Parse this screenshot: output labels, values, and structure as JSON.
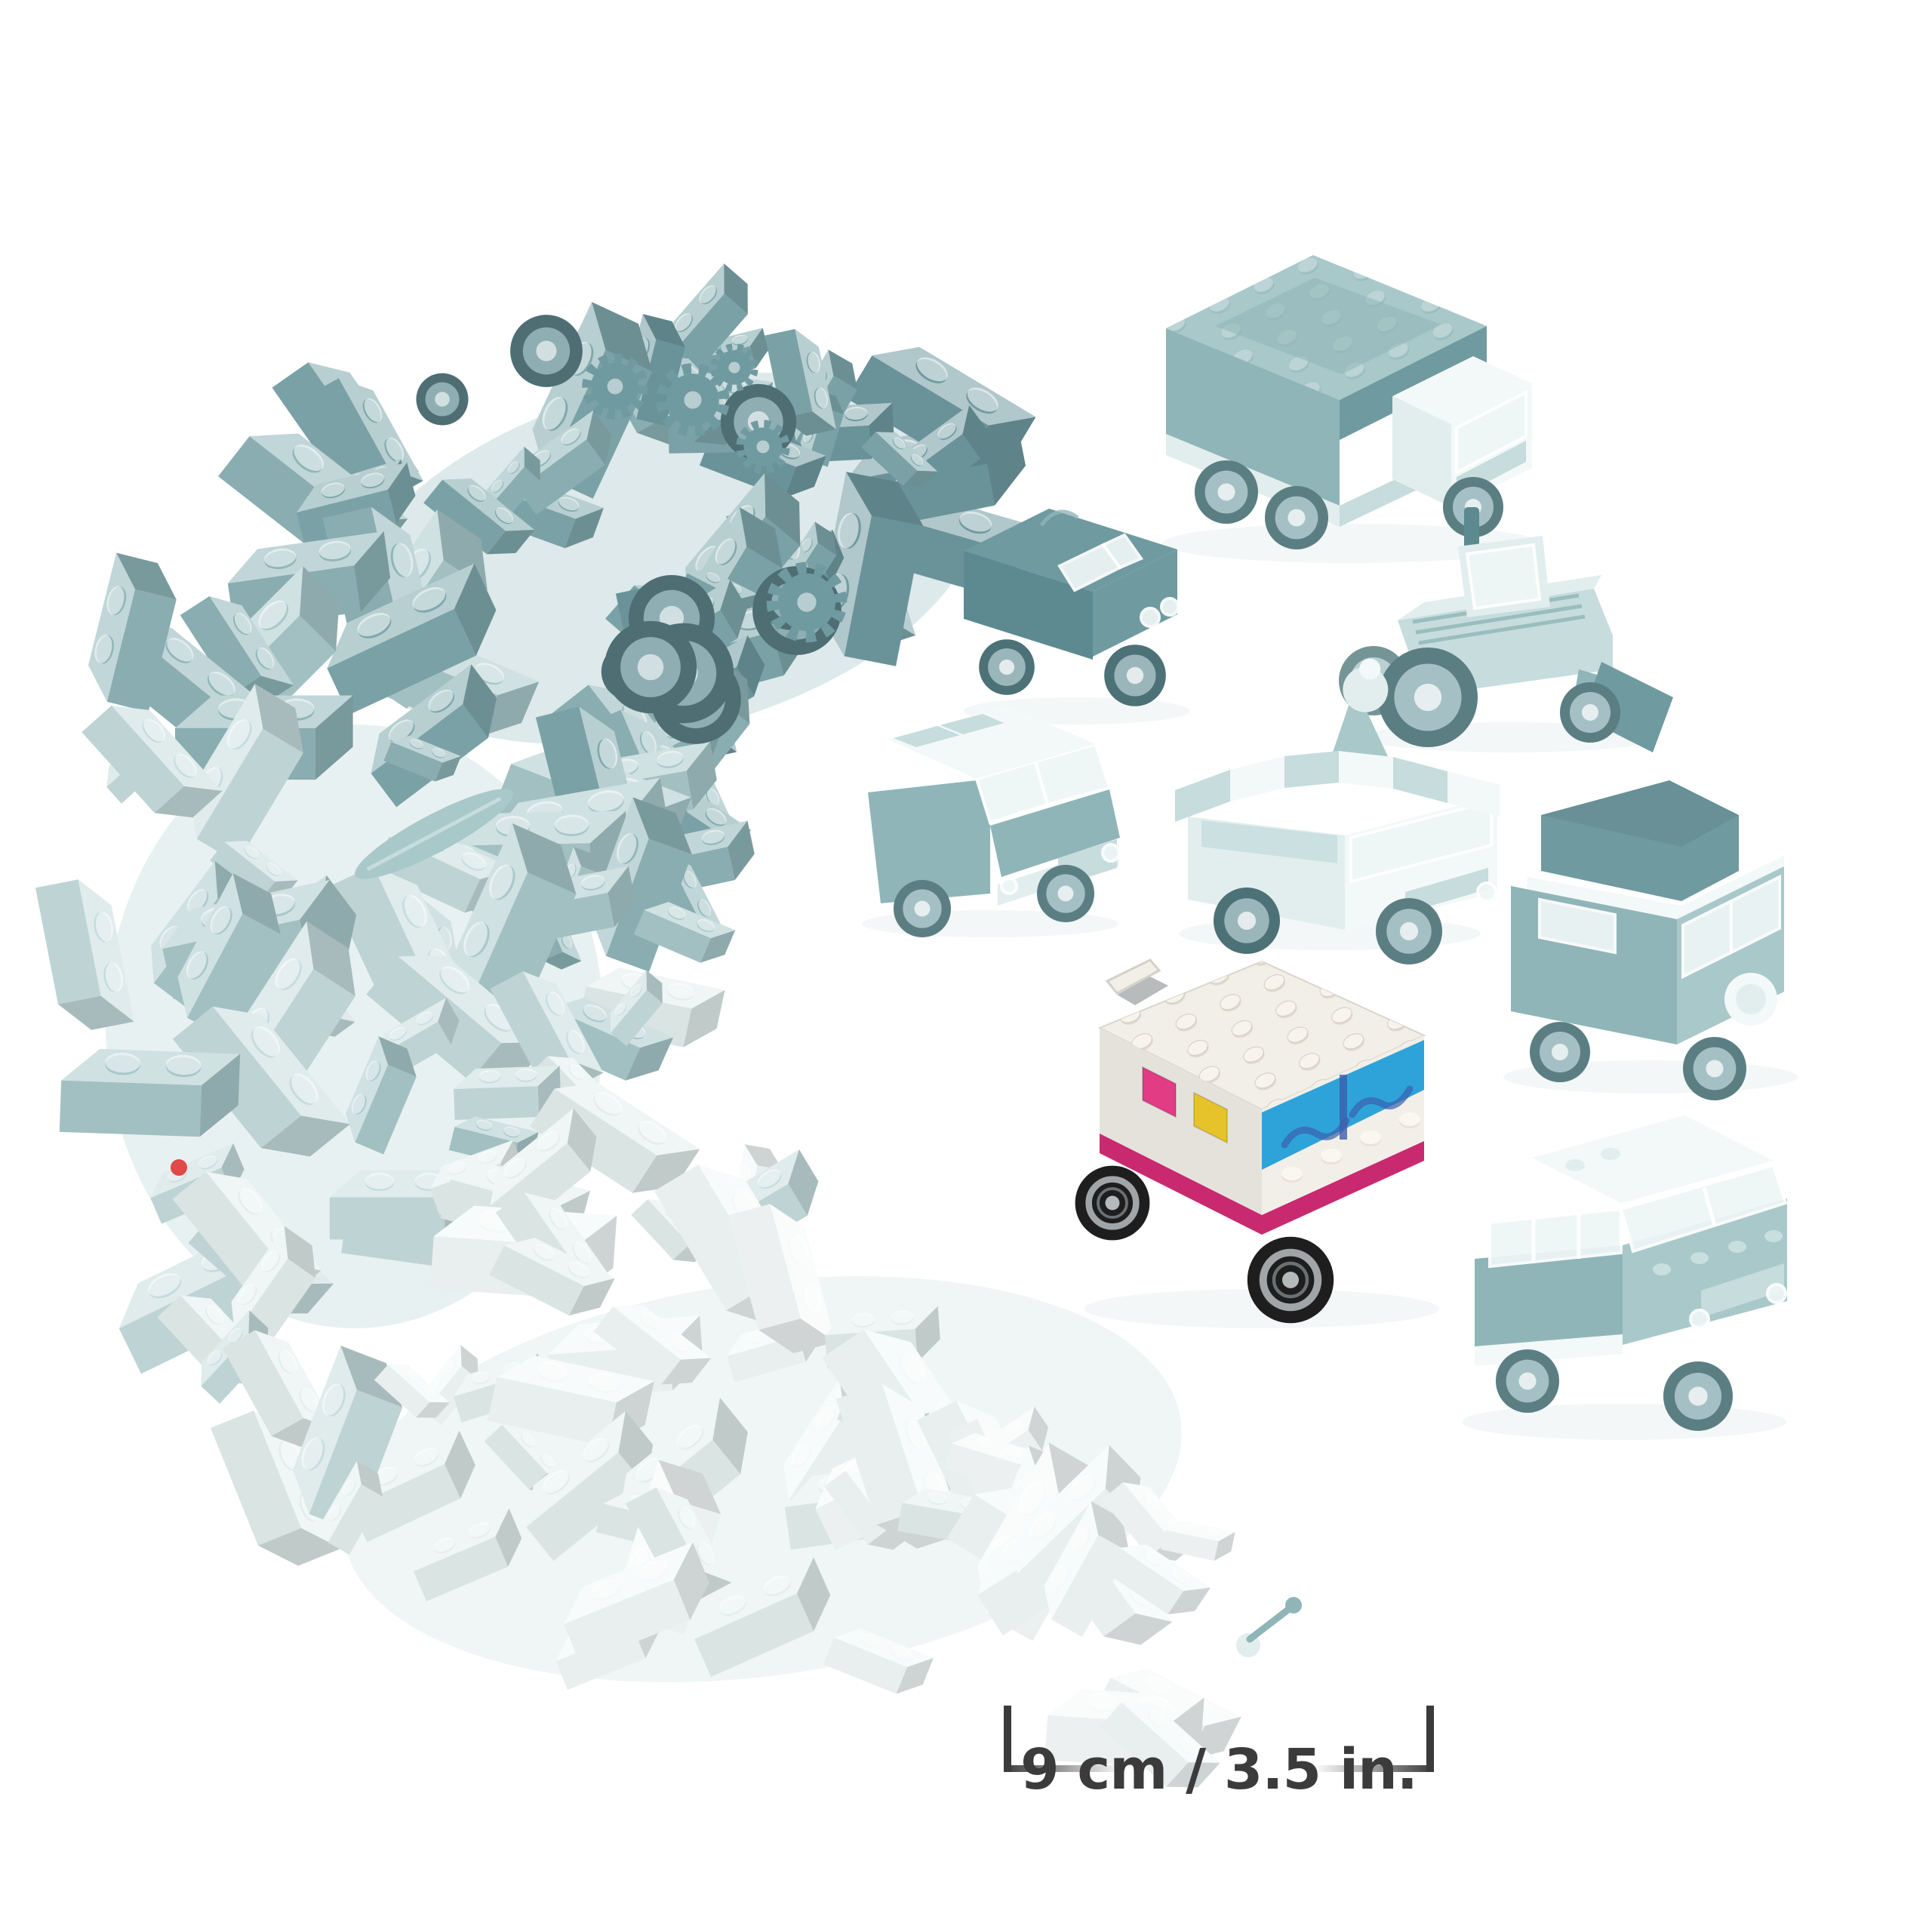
{
  "annotation": {
    "size_label": "9 cm / 3.5 in."
  },
  "palette": {
    "background": "#ffffff",
    "teal_darkest": "#5d8a91",
    "teal_dark": "#6f9aa0",
    "teal": "#8fb5b8",
    "teal_mid_light": "#a9c8ca",
    "teal_light": "#c6dcdd",
    "teal_pale": "#e2eeed",
    "near_white": "#f3f8f8",
    "van_white": "#f2efe8",
    "van_shadow": "#d9d5cb",
    "accent_magenta": "#c9296f",
    "accent_magenta_bright": "#e23c84",
    "accent_blue": "#2ea3da",
    "accent_blue_deep": "#3b5fae",
    "accent_yellow": "#e6c32a",
    "wheel_black": "#1e1e1e",
    "hub_silver": "#a9adb0",
    "clear_brick": "#eef6f6",
    "red_accent": "#e12b2b",
    "text": "#3b3b3b"
  },
  "models": [
    {
      "id": "brick-pile"
    },
    {
      "id": "box-truck"
    },
    {
      "id": "roadster-pickup"
    },
    {
      "id": "tractor-loader"
    },
    {
      "id": "suv-white-roof"
    },
    {
      "id": "ice-cream-truck"
    },
    {
      "id": "camper-van"
    },
    {
      "id": "creative-van",
      "highlighted": true
    },
    {
      "id": "station-wagon"
    }
  ]
}
